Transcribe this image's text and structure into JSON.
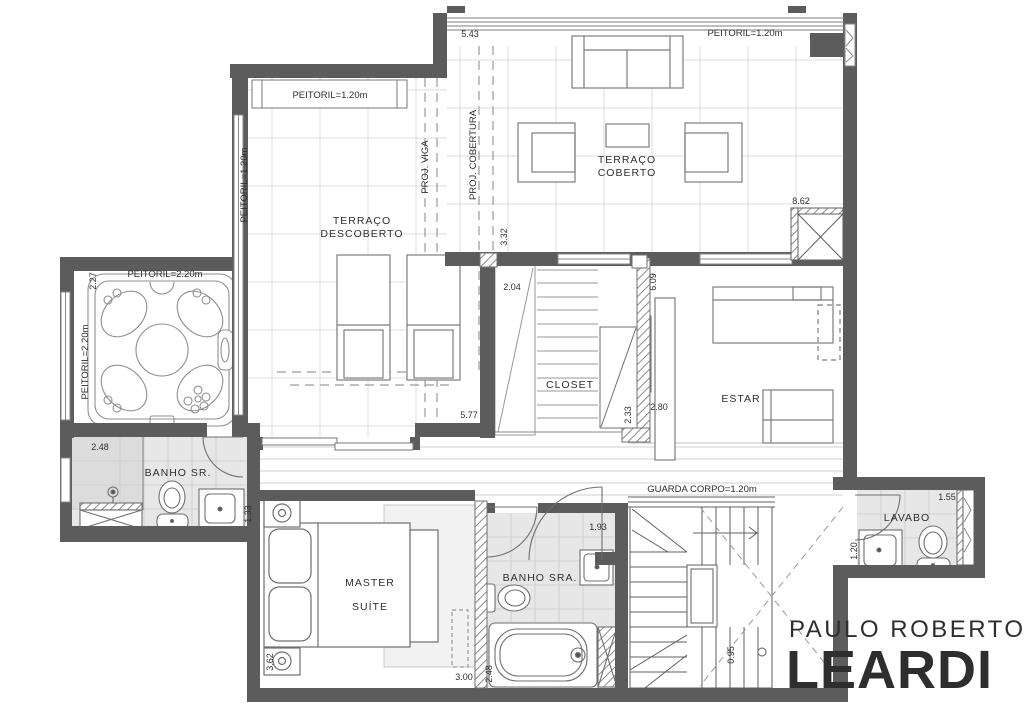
{
  "labels": {
    "terraco_coberto_1": "TERRAÇO",
    "terraco_coberto_2": "COBERTO",
    "terraco_descoberto_1": "TERRAÇO",
    "terraco_descoberto_2": "DESCOBERTO",
    "closet": "CLOSET",
    "estar": "ESTAR",
    "banho_sr": "BANHO  SR.",
    "banho_sra": "BANHO  SRA.",
    "master_1": "MASTER",
    "master_2": "SUÍTE",
    "lavabo": "LAVABO"
  },
  "annotations": {
    "peitoril_coberto": "PEITORIL=1.20m",
    "peitoril_descoberto_window": "PEITORIL=1.20m",
    "peitoril_descoberto_wall": "PEITORIL=1.20m",
    "peitoril_spa_top": "PEITORIL=2.20m",
    "peitoril_spa_left": "PEITORIL=2.20m",
    "proj_viga": "PROJ. VIGA",
    "proj_cobertura": "PROJ. COBERTURA",
    "guarda_corpo": "GUARDA CORPO=1.20m"
  },
  "dimensions": {
    "d543": "5.43",
    "d332": "3.32",
    "d577": "5.77",
    "d862": "8.62",
    "d204": "2.04",
    "d609": "6.09",
    "d233": "2.33",
    "d280": "2.80",
    "d227": "2.27",
    "d248_banho_sr": "2.48",
    "d133": "1.33",
    "d362": "3.62",
    "d300": "3.00",
    "d248_banho_sra": "2.48",
    "d193": "1.93",
    "d095": "0.95",
    "d155": "1.55",
    "d120": "1.20"
  },
  "logo": {
    "line1": "PAULO ROBERTO",
    "line2": "LEARDI"
  },
  "colors": {
    "wall": "#5c5c5c",
    "logo_light": "#4e93c8",
    "logo_dark": "#15689f"
  }
}
